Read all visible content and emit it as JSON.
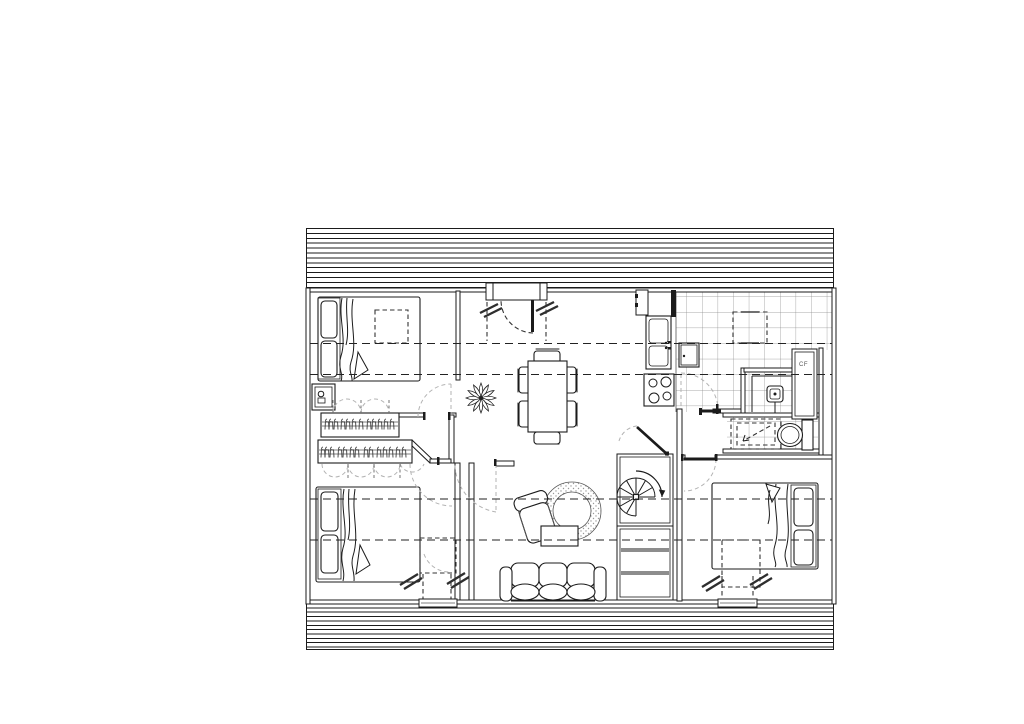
{
  "page": {
    "background": "#ffffff",
    "content": "architectural floor plan drawing on blank sheet"
  },
  "floor_plan": {
    "type": "architectural-floor-plan-top-view",
    "labels": {
      "water_heater_closet": "CF"
    },
    "colors": {
      "line": "#1b1b1b",
      "tile_line": "#8a8a8a",
      "swing_arc": "#b3b3b3",
      "background": "#ffffff"
    },
    "structure": {
      "roof_bands": [
        "top-hatched-band",
        "bottom-hatched-band"
      ],
      "ceiling_height_dashed_lines": 4,
      "entry": "recessed-entry-door-top-center"
    },
    "rooms": [
      {
        "name": "bedroom-top-left",
        "items": [
          "double-bed",
          "two-pillows",
          "dashed-roof-window-over-bed",
          "wardrobe-with-hangers",
          "small-wall-unit",
          "swing-door"
        ]
      },
      {
        "name": "entry-dining-hall",
        "items": [
          "entry-door",
          "plant-star-symbol",
          "dining-table",
          "six-chairs"
        ]
      },
      {
        "name": "kitchen",
        "items": [
          "tiled-floor",
          "tall-unit",
          "double-sink",
          "cooktop-4-burners",
          "dishwasher",
          "dashed-roof-window",
          "swing-door"
        ]
      },
      {
        "name": "shower-room",
        "items": [
          "shower-tray",
          "mixer-fixture",
          "water-heater-closet-CF"
        ]
      },
      {
        "name": "wc",
        "items": [
          "toilet-with-cistern",
          "dashed-appliance-reservation",
          "door-leaf"
        ]
      },
      {
        "name": "bedroom-bottom-left",
        "items": [
          "double-bed",
          "two-pillows",
          "wardrobe-with-hangers",
          "dashed-roof-window",
          "window-with-sill",
          "swing-door"
        ]
      },
      {
        "name": "living-room",
        "items": [
          "sofa-3-seat",
          "armchair",
          "round-rug",
          "coffee-table",
          "swing-door"
        ]
      },
      {
        "name": "stair-hall",
        "items": [
          "spiral-staircase",
          "storage-shaft-with-shelves",
          "diagonal-door"
        ]
      },
      {
        "name": "bedroom-bottom-right",
        "items": [
          "double-bed",
          "two-pillows",
          "dashed-roof-window",
          "window-with-sill",
          "swing-door"
        ]
      }
    ]
  }
}
